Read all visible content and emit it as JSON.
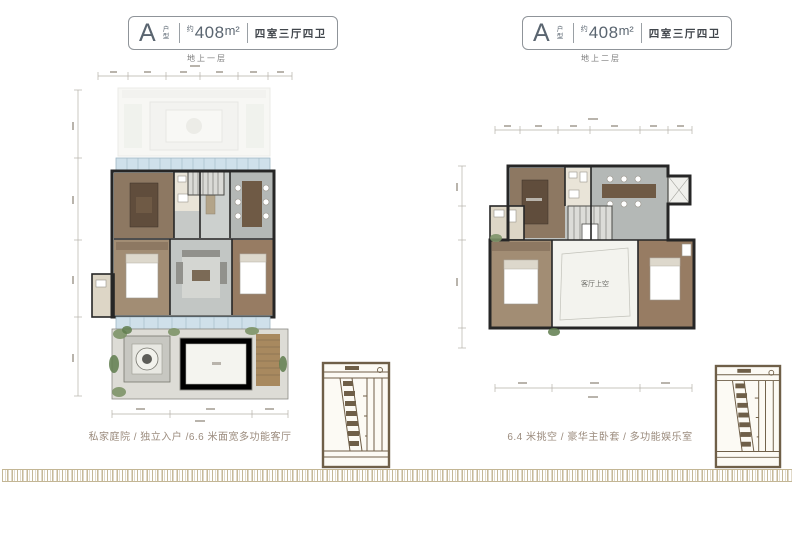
{
  "colors": {
    "badge_border": "#8f9499",
    "badge_text": "#5a6570",
    "rooms_text": "#41464c",
    "floor_label_text": "#7c7c7c",
    "caption_text": "#9b8b7d",
    "wall": "#262626",
    "floor_gray": "#c6c9c7",
    "wood_dark": "#8d7862",
    "wood_light": "#a28d74",
    "window_blue": "#cfe0ea",
    "plant_green": "#7d9468",
    "courtyard_pave": "#dddcd6",
    "site_map_sepia": "#6f5f48",
    "meander_border": "#c3b695"
  },
  "panels": [
    {
      "badge": {
        "unit_letter": "A",
        "unit_word": "户型",
        "approx": "约",
        "area_value": "408",
        "area_unit": "m²",
        "rooms": "四室三厅四卫"
      },
      "floor_label": "地上一层",
      "caption": "私家庭院 / 独立入户 /6.6 米面宽多功能客厅"
    },
    {
      "badge": {
        "unit_letter": "A",
        "unit_word": "户型",
        "approx": "约",
        "area_value": "408",
        "area_unit": "m²",
        "rooms": "四室三厅四卫"
      },
      "floor_label": "地上二层",
      "caption": "6.4 米挑空 / 豪华主卧套 / 多功能娱乐室",
      "plan_labels": {
        "void": "客厅上空"
      }
    }
  ]
}
